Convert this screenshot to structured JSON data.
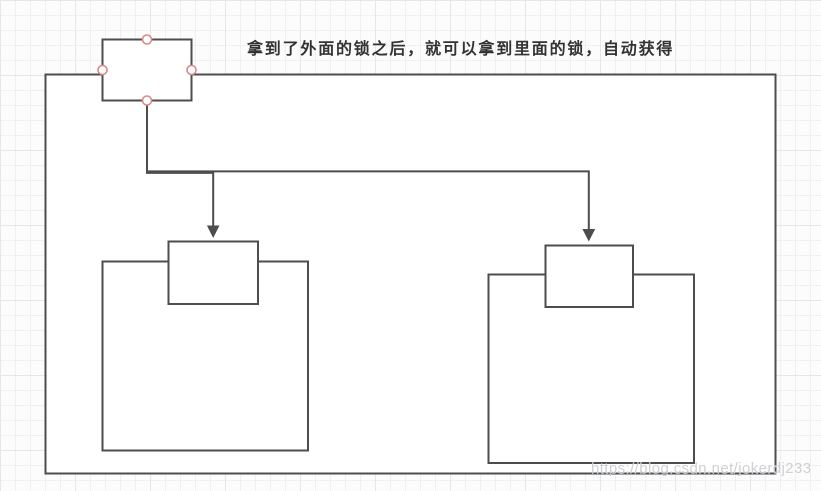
{
  "caption": "拿到了外面的锁之后，就可以拿到里面的锁，自动获得",
  "watermark": "https://blog.csdn.net/jokerdj233",
  "colors": {
    "stroke": "#4d4d4d",
    "shape_fill": "#ffffff",
    "connection_point": "#d98b8b",
    "caption_text": "#333333",
    "watermark_text": "#c8ccd0",
    "grid_minor": "#f0f0f0",
    "grid_major": "#e6e6e6",
    "background": "#fcfcfc"
  }
}
